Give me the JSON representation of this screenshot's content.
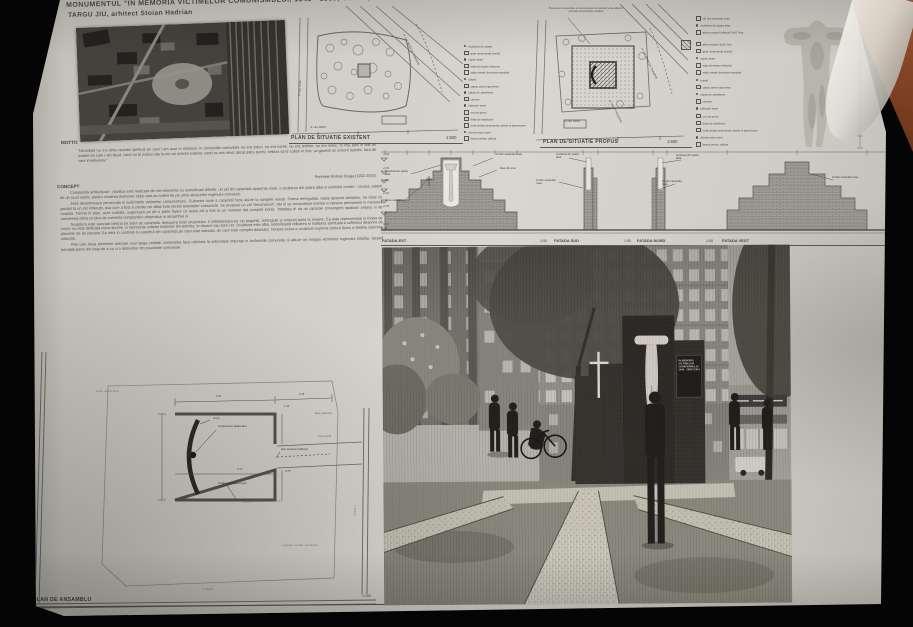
{
  "header": {
    "title_line1": "MONUMENTUL \"IN MEMORIA VICTIMELOR COMUNISMULUI, 1945 - 1989, GORJ\",",
    "title_line2": "TARGU JIU, arhitect Stoian Hadrian"
  },
  "plan_existent": {
    "label": "PLAN DE SITUATIE EXISTENT",
    "scale": "1:500",
    "street": "nr. cad. 55333 (str. Republicii)",
    "cad_a": "nr. cad. 39762",
    "cad_b": "nr. cad. 39261",
    "legend": [
      "sculptura din piatra",
      "gard ornamental (vechi)",
      "copac tanar",
      "stalp iluminare electrica",
      "stalp metalic iluminare stradala",
      "bolard",
      "capac camin apometru",
      "capac de canalizare",
      "cismea",
      "indicator rutier",
      "cos de gunoi",
      "firida de distributie",
      "rond peisaj ornamental, pietris si aspersoare",
      "directie auto rutier",
      "banca pentru odihna"
    ]
  },
  "plan_propus": {
    "label": "PLAN DE SITUATIE PROPUS",
    "scale": "1:500",
    "note": "Propunere de amenajare a monumentului si a spatiului verde adiacent (vezi plan de ansamblu si fatade)",
    "street": "nr. cad. 55333 (str. Republicii)",
    "sidewalk": "nr. cad. 57748 (trotuar)",
    "cad_a": "nr. cad. 39261",
    "legend": [
      "zid din caramida rosie",
      "sculptura din piatra alba",
      "alee propusa (criblura) 3x61 l/mp",
      "alee propusa 3x61 l/mp",
      "gard ornamental (vechi)",
      "copac tanar",
      "stalp iluminare electrica",
      "stalp metalic iluminare stradala",
      "bolard",
      "capac camin apometru",
      "capac de canalizare",
      "cismea",
      "indicator rutier",
      "cos de gunoi",
      "firida de distributie",
      "rond peisaj ornamental, pietris si aspersoare",
      "directie auto rutier",
      "banca pentru odihna"
    ]
  },
  "motto": {
    "heading": "MOTTO",
    "quote": "\"Niciodata nu s-a atins resortul spiritual pe care l-am avut in inchisori. In inchisorile comuniste nu era ziduri, nu era hartie, nu era telefon, nu era nimic. Si mai ales in anii de izolare pe care i-am facut, cand nu te puteai uita la nici un orizont exterior, cand nu era nimic decat patru pereti, trebuia sa te cobori in tine, sa gasesti un orizont launtric, fara de care innebuneai.\"",
    "attribution": "Parintele Roman Braga (1922-2015)"
  },
  "concept": {
    "heading": "CONCEPT",
    "paragraphs": [
      "Compozitia arhitectural - plastica este realizata din trei elemente cu semnificatii diferite: un zid din caramida aparenta rosie, o sculptura din piatra alba si simbolul crestin - crucea, alaturi de un scurt istoric, pentru cinstirea memoriei celor care au suferit de pe urma abuzurilor regimului comunist.",
      "Zidul desemneaza persecutia si suferintele victimelor comunismului. Culoarea rosie a caramizii face aluzie la sangele varsat. Forma neregulata, taiata aparent aleatoriu, ne duce cu gandul la un zid intrerupt, asa cum a fost si pentru cei aflati intre peretii temnitelor comuniste. Se propune un zid \"deconstruit\", dar el se reconstituie mental si ramane permanent in memoria noastra. Forma in plan, usor curbata, sugereaza pe de o parte faptul ca acest zid a fost la un moment dat complet inchis. Totodata el da un caracter convergent spatiului propus si de asemenea ofera un plus de coerenta compozitiei urbanistice in ansamblul ei.",
      "Sculptura este asezata central pe zidul de caramida, deasupra liniei orizontului. Ii simbolizeaza pe cei prigoniti, schingiuiti si torturati pana la moarte. Ea este reprezentata in forma de cruce; nu este dedicata cuiva anume, ci reprezinta sufletul martirilor din temnite, in drumul sau spre cer. Sculptura este alba, semnificand ridicarea si inaltarea spirituala a sufletului desprins de placerile de pe pamant. Ea intra in contrast cu suportul din caramida pe care este asezata, de care este complet detasata. Textura incisa a sculpturii exprima tortura fizica si teribila suferinta indurata.",
      "Prin cele doua elemente asezate unul langa celalalt, compozitia face referinta la suferintele indurate in inchisorile comuniste si aduce un omagiu victimelor regimului totalitar, facand totodata parte din viata de zi cu zi a detinutilor din puscariile comuniste."
    ]
  },
  "facades": {
    "items": [
      {
        "label": "FATADA EST",
        "scale": "1:50"
      },
      {
        "label": "FATADA SUD",
        "scale": "1:50"
      },
      {
        "label": "FATADA NORD",
        "scale": "1:50"
      },
      {
        "label": "FATADA VEST",
        "scale": "1:50"
      }
    ],
    "ann": {
      "sculpture": "sculptura din piatra alba",
      "wall": "zid din caramida rosie",
      "letters": "litere din inox",
      "cross": "cruce metalica"
    },
    "levels": [
      "+4.45",
      "+3.60",
      "+2.50",
      "+1.50",
      "+0.45",
      "±0.00"
    ]
  },
  "ansamblu": {
    "label": "PLAN DE ANSAMBLU",
    "scale": "1:100",
    "labels": {
      "path_top": "alee asfaltata",
      "cross": "cruce",
      "sculpture": "sculptura din piatra alba",
      "path_proposed": "alee propusa (criblura)",
      "wall": "zid din caramida propus",
      "green_center": "spatiu verde amenajat",
      "green_bottom": "spatiu verde existent",
      "sidewalk_bottom": "trotuar",
      "sidewalk_right": "trotuar",
      "path_right1": "alee existenta",
      "path_right2": "zona verde"
    },
    "dims": {
      "d1": "5.00",
      "d2": "0.75",
      "d3": "1.10",
      "d4": "4.70",
      "d5": "2.75",
      "d6": "0.70"
    }
  },
  "photo": {
    "plaque": [
      "IN MEMORIA",
      "VICTIMELOR",
      "COMUNISMULUI",
      "1945 - 1989 GORJ"
    ]
  }
}
